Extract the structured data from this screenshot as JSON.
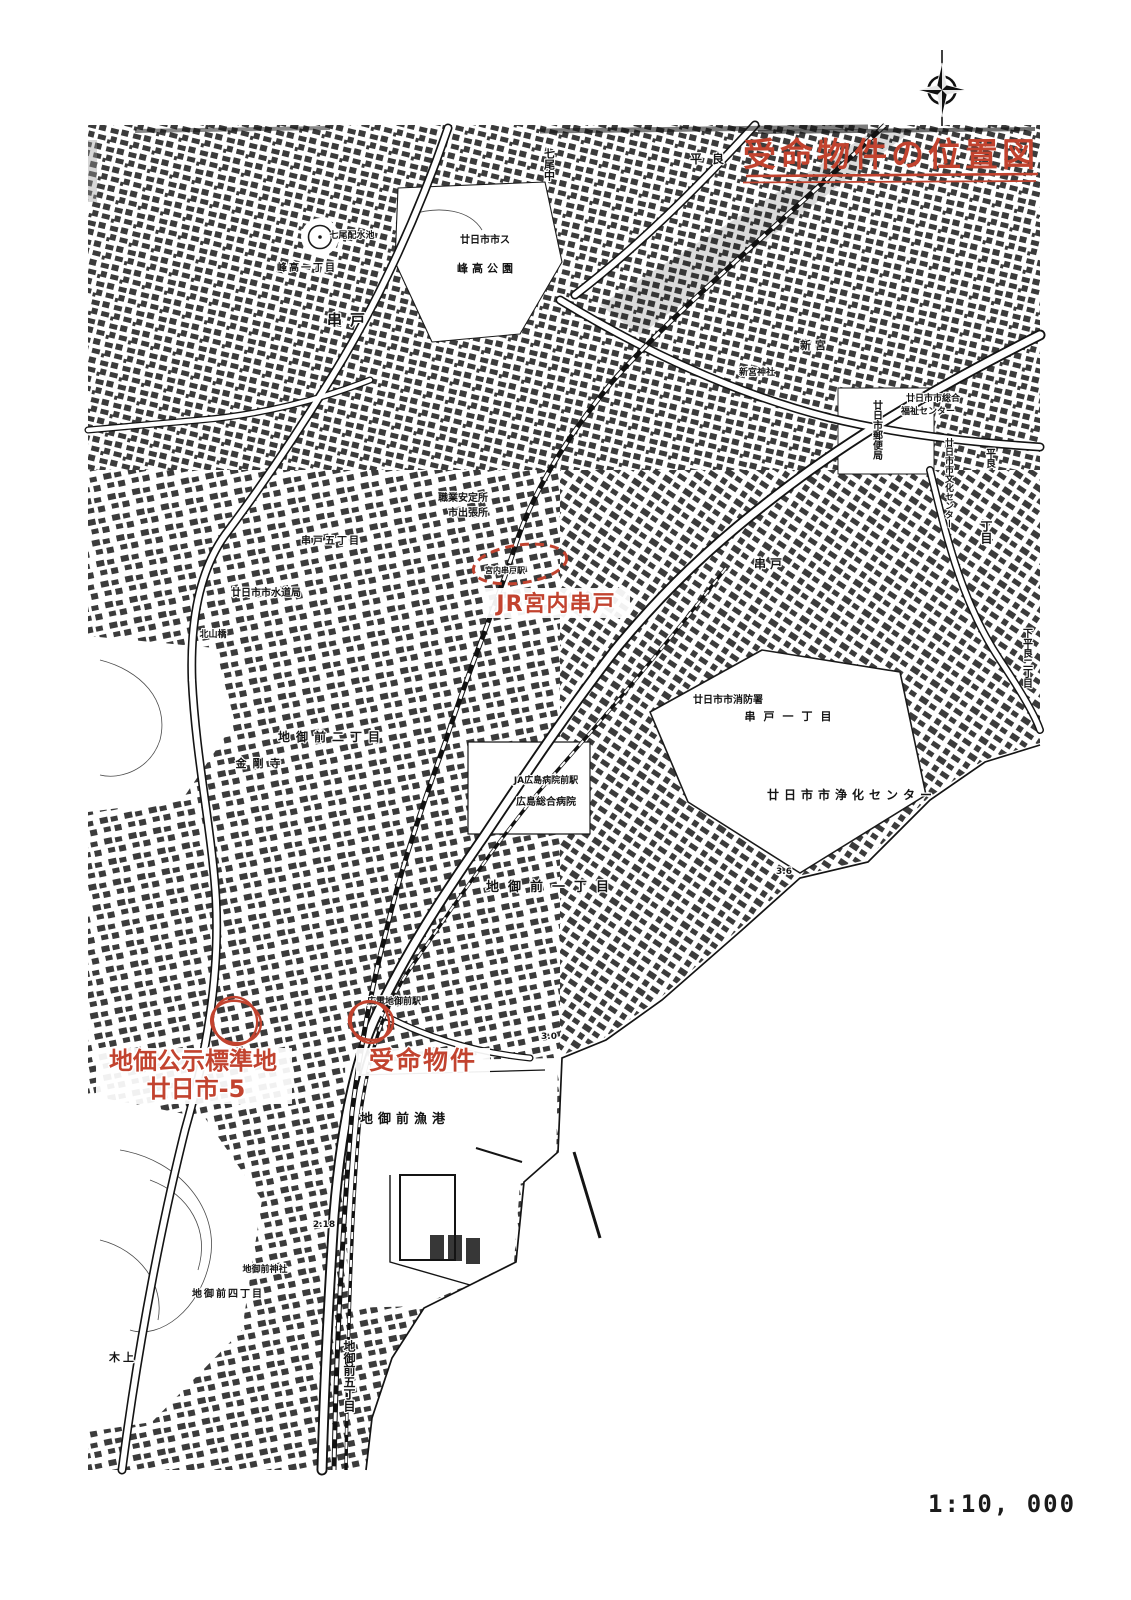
{
  "colors": {
    "annotation_red": "#c2432f",
    "map_ink": "#161616",
    "paper": "#ffffff"
  },
  "title": {
    "text": "受命物件の位置図",
    "underline_style": "double-red"
  },
  "compass": {
    "icon": "compass-rose-icon"
  },
  "scale": {
    "text": "1:10, 000"
  },
  "annotations": {
    "station": {
      "label": "JR宮内串戸",
      "marker": "red-dashed-ellipse"
    },
    "land_price": {
      "label_line1": "地価公示標準地",
      "label_line2": "廿日市-5",
      "marker": "red-circle"
    },
    "property": {
      "label": "受命物件",
      "marker": "red-circle"
    }
  },
  "map_labels": [
    {
      "text": "串戸",
      "x": 350,
      "y": 325,
      "size": 15,
      "ls": 8
    },
    {
      "text": "七尾配水池",
      "x": 352,
      "y": 238,
      "size": 9
    },
    {
      "text": "峰高一丁目",
      "x": 307,
      "y": 271,
      "size": 10,
      "ls": 2
    },
    {
      "text": "廿日市市ス",
      "x": 485,
      "y": 243,
      "size": 10
    },
    {
      "text": "峰高公園",
      "x": 487,
      "y": 272,
      "size": 11,
      "ls": 4
    },
    {
      "text": "七尾中",
      "x": 549,
      "y": 148,
      "size": 11,
      "vertical": true
    },
    {
      "text": "平良",
      "x": 712,
      "y": 163,
      "size": 12,
      "ls": 10
    },
    {
      "text": "新宮神社",
      "x": 757,
      "y": 375,
      "size": 9
    },
    {
      "text": "新宮",
      "x": 815,
      "y": 349,
      "size": 11,
      "ls": 4
    },
    {
      "text": "廿日市郵便局",
      "x": 876,
      "y": 400,
      "size": 10,
      "vertical": true
    },
    {
      "text": "廿日市市総合",
      "x": 933,
      "y": 401,
      "size": 9
    },
    {
      "text": "福祉センター",
      "x": 928,
      "y": 414,
      "size": 9
    },
    {
      "text": "廿日市市文化センター",
      "x": 948,
      "y": 438,
      "size": 9,
      "vertical": true
    },
    {
      "text": "平良",
      "x": 989,
      "y": 448,
      "size": 10,
      "vertical": true
    },
    {
      "text": "丁目",
      "x": 986,
      "y": 520,
      "size": 12,
      "vertical": true
    },
    {
      "text": "下平良二丁目",
      "x": 1026,
      "y": 628,
      "size": 10,
      "vertical": true
    },
    {
      "text": "串戸",
      "x": 770,
      "y": 568,
      "size": 12,
      "ls": 4
    },
    {
      "text": "串戸一丁目",
      "x": 792,
      "y": 720,
      "size": 11,
      "ls": 8
    },
    {
      "text": "廿日市市消防署",
      "x": 728,
      "y": 703,
      "size": 10
    },
    {
      "text": "廿日市市浄化センター",
      "x": 852,
      "y": 799,
      "size": 12,
      "ls": 5
    },
    {
      "text": "廿日市市水道局",
      "x": 266,
      "y": 596,
      "size": 10
    },
    {
      "text": "北山橋",
      "x": 213,
      "y": 637,
      "size": 9
    },
    {
      "text": "串戸五丁目",
      "x": 331,
      "y": 544,
      "size": 10,
      "ls": 2
    },
    {
      "text": "職業安定所",
      "x": 463,
      "y": 501,
      "size": 10
    },
    {
      "text": "市出張所",
      "x": 468,
      "y": 516,
      "size": 10
    },
    {
      "text": "宮内串戸駅",
      "x": 505,
      "y": 573,
      "size": 8
    },
    {
      "text": "地御前二丁目",
      "x": 332,
      "y": 741,
      "size": 12,
      "ls": 6
    },
    {
      "text": "金剛寺",
      "x": 261,
      "y": 767,
      "size": 11,
      "ls": 6
    },
    {
      "text": "JA広島病院前駅",
      "x": 546,
      "y": 783,
      "size": 9
    },
    {
      "text": "広島総合病院",
      "x": 546,
      "y": 805,
      "size": 10
    },
    {
      "text": "地御前一丁目",
      "x": 552,
      "y": 891,
      "size": 13,
      "ls": 9
    },
    {
      "text": "広電地御前駅",
      "x": 394,
      "y": 1004,
      "size": 9
    },
    {
      "text": "地御前漁港",
      "x": 405,
      "y": 1123,
      "size": 13,
      "ls": 5
    },
    {
      "text": "地御前神社",
      "x": 265,
      "y": 1272,
      "size": 9
    },
    {
      "text": "地御前四丁目",
      "x": 228,
      "y": 1297,
      "size": 10,
      "ls": 2
    },
    {
      "text": "地御前五丁目",
      "x": 349,
      "y": 1340,
      "size": 12,
      "vertical": true
    },
    {
      "text": "木上",
      "x": 123,
      "y": 1361,
      "size": 11,
      "ls": 3
    },
    {
      "text": "3.0",
      "x": 549,
      "y": 1039,
      "size": 9
    },
    {
      "text": "3.6",
      "x": 784,
      "y": 874,
      "size": 9
    },
    {
      "text": "2.18",
      "x": 324,
      "y": 1227,
      "size": 9
    }
  ]
}
